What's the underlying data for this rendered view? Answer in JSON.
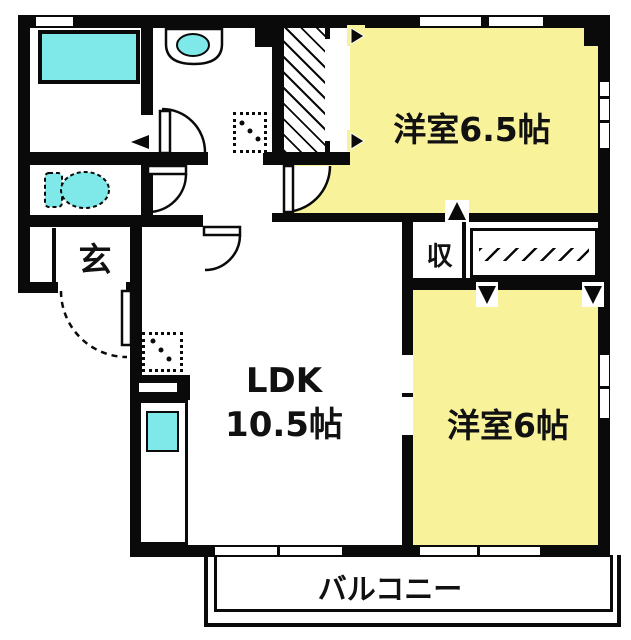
{
  "plan_title": "apartment-floor-plan",
  "colors": {
    "room_fill": "#F8F29B",
    "fixture_fill": "#7FE9E9",
    "wall": "#0a0a0a",
    "background": "#ffffff"
  },
  "rooms": {
    "western_6_5": {
      "label": "洋室6.5帖"
    },
    "western_6": {
      "label": "洋室6帖"
    },
    "ldk": {
      "label": "LDK",
      "size": "10.5帖"
    },
    "entrance": {
      "label": "玄"
    },
    "storage": {
      "label": "収"
    },
    "balcony": {
      "label": "バルコニー"
    }
  }
}
